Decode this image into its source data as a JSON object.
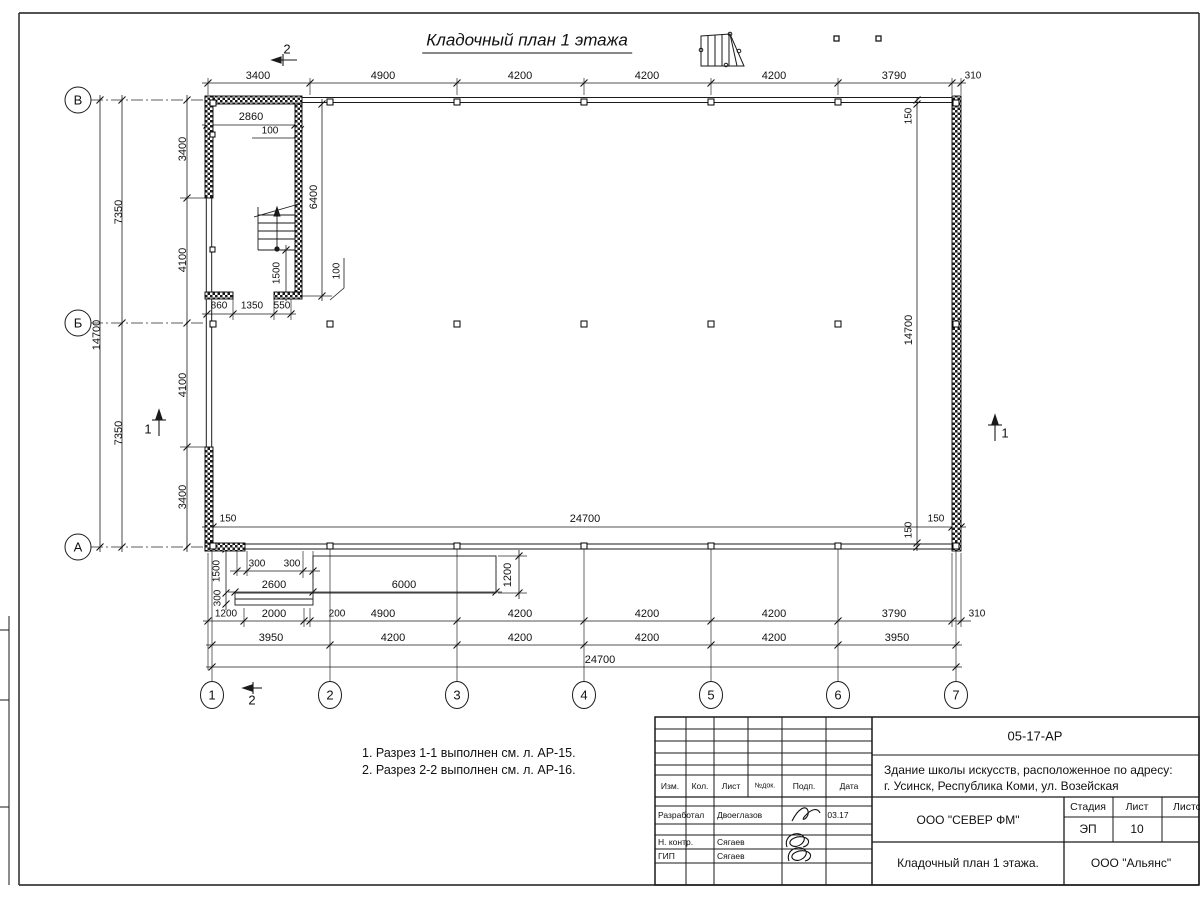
{
  "sheet": {
    "title": "Кладочный план 1 этажа",
    "notes": [
      "1. Разрез 1-1 выполнен см. л. АР-15.",
      "2. Разрез 2-2 выполнен см. л. АР-16."
    ]
  },
  "plan": {
    "labels": [
      {
        "t": "3400",
        "x": 258,
        "y": 76,
        "n": "dim-top"
      },
      {
        "t": "4900",
        "x": 383,
        "y": 76,
        "n": "dim-top"
      },
      {
        "t": "4200",
        "x": 520,
        "y": 76,
        "n": "dim-top"
      },
      {
        "t": "4200",
        "x": 647,
        "y": 76,
        "n": "dim-top"
      },
      {
        "t": "4200",
        "x": 774,
        "y": 76,
        "n": "dim-top"
      },
      {
        "t": "3790",
        "x": 894,
        "y": 76,
        "n": "dim-top"
      },
      {
        "t": "310",
        "x": 973,
        "y": 76,
        "cls": "s",
        "n": "dim-top"
      },
      {
        "t": "150",
        "x": 228,
        "y": 519,
        "cls": "s",
        "n": "dim-inner"
      },
      {
        "t": "24700",
        "x": 585,
        "y": 519,
        "n": "dim-inner"
      },
      {
        "t": "150",
        "x": 936,
        "y": 519,
        "cls": "s",
        "n": "dim-inner"
      },
      {
        "t": "14700",
        "x": 97,
        "y": 335,
        "r": 1,
        "n": "dim-left"
      },
      {
        "t": "7350",
        "x": 119,
        "y": 212,
        "r": 1,
        "n": "dim-left"
      },
      {
        "t": "7350",
        "x": 119,
        "y": 433,
        "r": 1,
        "n": "dim-left"
      },
      {
        "t": "3400",
        "x": 183,
        "y": 149,
        "r": 1,
        "n": "dim-left"
      },
      {
        "t": "4100",
        "x": 183,
        "y": 260,
        "r": 1,
        "n": "dim-left"
      },
      {
        "t": "4100",
        "x": 183,
        "y": 385,
        "r": 1,
        "n": "dim-left"
      },
      {
        "t": "3400",
        "x": 183,
        "y": 497,
        "r": 1,
        "n": "dim-left"
      },
      {
        "t": "150",
        "x": 909,
        "y": 116,
        "r": 1,
        "cls": "s",
        "n": "dim-right"
      },
      {
        "t": "14700",
        "x": 909,
        "y": 330,
        "r": 1,
        "n": "dim-right"
      },
      {
        "t": "150",
        "x": 909,
        "y": 530,
        "r": 1,
        "cls": "s",
        "n": "dim-right"
      },
      {
        "t": "2860",
        "x": 251,
        "y": 117,
        "n": "dim-stair"
      },
      {
        "t": "100",
        "x": 270,
        "y": 131,
        "cls": "s",
        "n": "dim-stair"
      },
      {
        "t": "6400",
        "x": 314,
        "y": 197,
        "r": 1,
        "n": "dim-stair"
      },
      {
        "t": "1500",
        "x": 277,
        "y": 273,
        "r": 1,
        "cls": "s",
        "n": "dim-stair"
      },
      {
        "t": "100",
        "x": 337,
        "y": 271,
        "r": 1,
        "cls": "s",
        "n": "dim-stair"
      },
      {
        "t": "860",
        "x": 219,
        "y": 306,
        "cls": "s",
        "n": "dim-stair"
      },
      {
        "t": "1350",
        "x": 252,
        "y": 306,
        "cls": "s",
        "n": "dim-stair"
      },
      {
        "t": "550",
        "x": 282,
        "y": 306,
        "cls": "s",
        "n": "dim-stair"
      },
      {
        "t": "300",
        "x": 257,
        "y": 564,
        "cls": "s",
        "n": "dim-porch"
      },
      {
        "t": "300",
        "x": 292,
        "y": 564,
        "cls": "s",
        "n": "dim-porch"
      },
      {
        "t": "2600",
        "x": 274,
        "y": 585,
        "n": "dim-porch"
      },
      {
        "t": "6000",
        "x": 404,
        "y": 585,
        "n": "dim-porch"
      },
      {
        "t": "1200",
        "x": 508,
        "y": 575,
        "r": 1,
        "n": "dim-porch"
      },
      {
        "t": "1500",
        "x": 217,
        "y": 571,
        "r": 1,
        "cls": "s",
        "n": "dim-porch"
      },
      {
        "t": "300",
        "x": 218,
        "y": 598,
        "r": 1,
        "cls": "s",
        "n": "dim-porch"
      },
      {
        "t": "1200",
        "x": 226,
        "y": 614,
        "cls": "s",
        "n": "dim-bottom1"
      },
      {
        "t": "2000",
        "x": 274,
        "y": 614,
        "n": "dim-bottom1"
      },
      {
        "t": "200",
        "x": 337,
        "y": 614,
        "cls": "s",
        "n": "dim-bottom1"
      },
      {
        "t": "4900",
        "x": 383,
        "y": 614,
        "n": "dim-bottom1"
      },
      {
        "t": "4200",
        "x": 520,
        "y": 614,
        "n": "dim-bottom1"
      },
      {
        "t": "4200",
        "x": 647,
        "y": 614,
        "n": "dim-bottom1"
      },
      {
        "t": "4200",
        "x": 774,
        "y": 614,
        "n": "dim-bottom1"
      },
      {
        "t": "3790",
        "x": 894,
        "y": 614,
        "n": "dim-bottom1"
      },
      {
        "t": "310",
        "x": 977,
        "y": 614,
        "cls": "s",
        "n": "dim-bottom1"
      },
      {
        "t": "3950",
        "x": 271,
        "y": 638,
        "n": "dim-bottom2"
      },
      {
        "t": "4200",
        "x": 393,
        "y": 638,
        "n": "dim-bottom2"
      },
      {
        "t": "4200",
        "x": 520,
        "y": 638,
        "n": "dim-bottom2"
      },
      {
        "t": "4200",
        "x": 647,
        "y": 638,
        "n": "dim-bottom2"
      },
      {
        "t": "4200",
        "x": 774,
        "y": 638,
        "n": "dim-bottom2"
      },
      {
        "t": "3950",
        "x": 897,
        "y": 638,
        "n": "dim-bottom2"
      },
      {
        "t": "24700",
        "x": 600,
        "y": 660,
        "n": "dim-bottom3"
      },
      {
        "t": "В",
        "x": 78,
        "y": 100,
        "cls": "axis",
        "n": "axis-row-label"
      },
      {
        "t": "Б",
        "x": 78,
        "y": 323,
        "cls": "axis",
        "n": "axis-row-label"
      },
      {
        "t": "А",
        "x": 78,
        "y": 547,
        "cls": "axis",
        "n": "axis-row-label"
      },
      {
        "t": "1",
        "x": 212,
        "y": 695,
        "cls": "axis",
        "n": "axis-col-label"
      },
      {
        "t": "2",
        "x": 330,
        "y": 695,
        "cls": "axis",
        "n": "axis-col-label"
      },
      {
        "t": "3",
        "x": 457,
        "y": 695,
        "cls": "axis",
        "n": "axis-col-label"
      },
      {
        "t": "4",
        "x": 584,
        "y": 695,
        "cls": "axis",
        "n": "axis-col-label"
      },
      {
        "t": "5",
        "x": 711,
        "y": 695,
        "cls": "axis",
        "n": "axis-col-label"
      },
      {
        "t": "6",
        "x": 838,
        "y": 695,
        "cls": "axis",
        "n": "axis-col-label"
      },
      {
        "t": "7",
        "x": 956,
        "y": 695,
        "cls": "axis",
        "n": "axis-col-label"
      },
      {
        "t": "2",
        "x": 287,
        "y": 49,
        "cls": "sec",
        "n": "section-mark-label"
      },
      {
        "t": "2",
        "x": 252,
        "y": 700,
        "cls": "sec",
        "n": "section-mark-label"
      },
      {
        "t": "1",
        "x": 148,
        "y": 429,
        "cls": "sec",
        "n": "section-mark-label"
      },
      {
        "t": "1",
        "x": 1005,
        "y": 433,
        "cls": "sec",
        "n": "section-mark-label"
      }
    ]
  },
  "title_block": {
    "code": "05-17-АР",
    "object_line1": "Здание школы искусств, расположенное по адресу:",
    "object_line2": "г. Усинск, Республика Коми, ул. Возейская",
    "org": "ООО \"СЕВЕР ФМ\"",
    "doc_title": "Кладочный план 1 этажа.",
    "firm": "ООО \"Альянс\"",
    "stage_label": "Стадия",
    "sheet_label": "Лист",
    "sheets_label": "Листов",
    "stage": "ЭП",
    "sheet_no": "10",
    "header_cols": [
      "Изм.",
      "Кол.",
      "Лист",
      "№док.",
      "Подп.",
      "Дата"
    ],
    "rows": [
      {
        "role": "Разработал",
        "name": "Двоеглазов",
        "date": "03.17"
      },
      {
        "role": "Н. контр.",
        "name": "Сягаев",
        "date": ""
      },
      {
        "role": "ГИП",
        "name": "Сягаев",
        "date": ""
      }
    ]
  }
}
